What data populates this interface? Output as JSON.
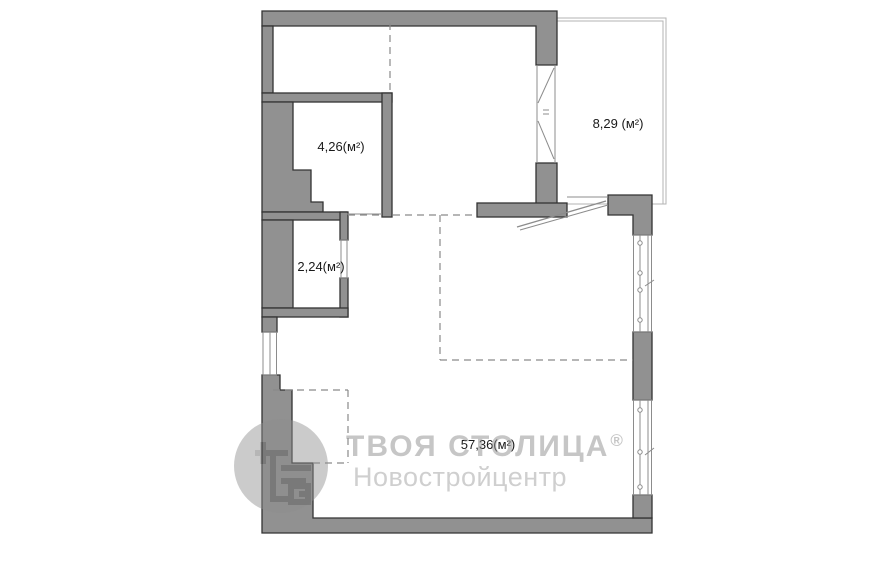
{
  "rooms": [
    {
      "id": "pantry-top",
      "label": "4,26(м²)"
    },
    {
      "id": "closet-bottom",
      "label": "2,24(м²)"
    },
    {
      "id": "balcony",
      "label": "8,29 (м²)"
    },
    {
      "id": "living-area",
      "label": "57,36(м²)"
    }
  ],
  "watermark": {
    "brand": "ТВОЯ СТОЛИЦА",
    "registered": "®",
    "subtitle": "Новостройцентр"
  },
  "colors": {
    "wall_fill": "#919191",
    "wall_stroke": "#333333",
    "thin": "#b3b3b3",
    "frame": "#8c8c8c",
    "dashed": "#8a8a8a",
    "label_text": "#1a1a1a",
    "watermark_gray": "#8e8e8e"
  }
}
